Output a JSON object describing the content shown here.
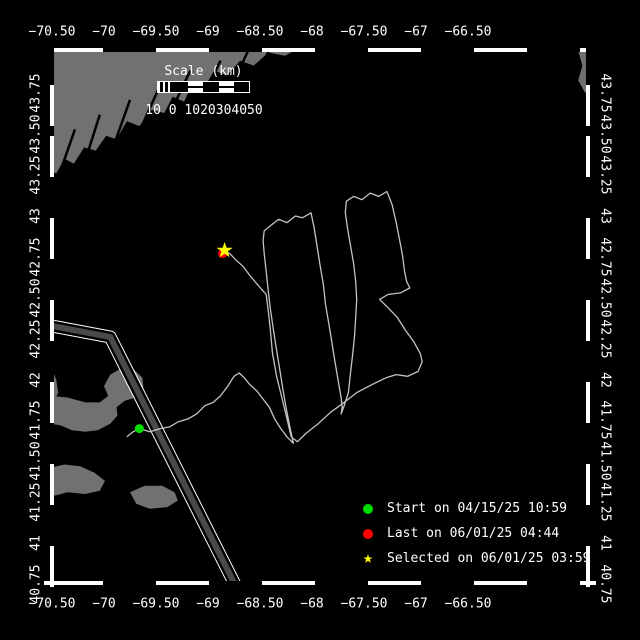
{
  "colors": {
    "background": "#000000",
    "frame": "#ffffff",
    "land": "#717171",
    "track": "#c4c4c4",
    "lane_fill": "#4a4a4a",
    "start_green": "#00dd00",
    "last_red": "#ff0000",
    "selected_yellow": "#ffff00",
    "text": "#ffffff"
  },
  "scale_bar": {
    "title": "Scale (km)",
    "tick_text": "10 0 1020304050",
    "tick_values_km": [
      10,
      0,
      10,
      20,
      30,
      40,
      50
    ]
  },
  "legend": {
    "items": [
      {
        "marker": "circle",
        "color": "#00dd00",
        "label": "Start on 04/15/25 10:59"
      },
      {
        "marker": "circle",
        "color": "#ff0000",
        "label": "Last on 06/01/25 04:44"
      },
      {
        "marker": "star",
        "color": "#ffff00",
        "label": "Selected on 06/01/25 03:59"
      }
    ]
  },
  "axes": {
    "lon_labels": [
      {
        "label": "−70.50",
        "lon": -70.5
      },
      {
        "label": "−70",
        "lon": -70.0
      },
      {
        "label": "−69.50",
        "lon": -69.5
      },
      {
        "label": "−69",
        "lon": -69.0
      },
      {
        "label": "−68.50",
        "lon": -68.5
      },
      {
        "label": "−68",
        "lon": -68.0
      },
      {
        "label": "−67.50",
        "lon": -67.5
      },
      {
        "label": "−67",
        "lon": -67.0
      },
      {
        "label": "−66.50",
        "lon": -66.5
      }
    ],
    "lat_labels": [
      {
        "label": "43.75",
        "lat": 43.75
      },
      {
        "label": "43.50",
        "lat": 43.5
      },
      {
        "label": "43.25",
        "lat": 43.25
      },
      {
        "label": "43",
        "lat": 43.0
      },
      {
        "label": "42.75",
        "lat": 42.75
      },
      {
        "label": "42.50",
        "lat": 42.5
      },
      {
        "label": "42.25",
        "lat": 42.25
      },
      {
        "label": "42",
        "lat": 42.0
      },
      {
        "label": "41.75",
        "lat": 41.75
      },
      {
        "label": "41.50",
        "lat": 41.5
      },
      {
        "label": "41.25",
        "lat": 41.25
      },
      {
        "label": "41",
        "lat": 41.0
      },
      {
        "label": "40.75",
        "lat": 40.75
      }
    ]
  },
  "chart_data": {
    "type": "line",
    "title": "Glider track map",
    "xlabel": "longitude (deg)",
    "ylabel": "latitude (deg)",
    "xlim": [
      -70.52,
      -65.33
    ],
    "ylim": [
      40.74,
      44.03
    ],
    "grid": false,
    "legend_position": "bottom-right",
    "markers": {
      "start": {
        "lon": -69.66,
        "lat": 41.7
      },
      "last": {
        "lon": -68.86,
        "lat": 42.77
      },
      "selected": {
        "lon": -68.84,
        "lat": 42.79
      }
    },
    "track_lonlat": [
      [
        -69.78,
        41.65
      ],
      [
        -69.72,
        41.68
      ],
      [
        -69.66,
        41.7
      ],
      [
        -69.56,
        41.68
      ],
      [
        -69.46,
        41.7
      ],
      [
        -69.37,
        41.71
      ],
      [
        -69.29,
        41.74
      ],
      [
        -69.19,
        41.76
      ],
      [
        -69.11,
        41.79
      ],
      [
        -69.03,
        41.84
      ],
      [
        -68.95,
        41.86
      ],
      [
        -68.88,
        41.9
      ],
      [
        -68.81,
        41.96
      ],
      [
        -68.75,
        42.02
      ],
      [
        -68.7,
        42.04
      ],
      [
        -68.65,
        42.01
      ],
      [
        -68.6,
        41.97
      ],
      [
        -68.53,
        41.93
      ],
      [
        -68.47,
        41.88
      ],
      [
        -68.41,
        41.83
      ],
      [
        -68.36,
        41.76
      ],
      [
        -68.3,
        41.7
      ],
      [
        -68.24,
        41.65
      ],
      [
        -68.18,
        41.61
      ],
      [
        -68.21,
        41.7
      ],
      [
        -68.25,
        41.83
      ],
      [
        -68.28,
        41.94
      ],
      [
        -68.31,
        42.06
      ],
      [
        -68.34,
        42.18
      ],
      [
        -68.37,
        42.3
      ],
      [
        -68.4,
        42.43
      ],
      [
        -68.42,
        42.54
      ],
      [
        -68.44,
        42.66
      ],
      [
        -68.46,
        42.77
      ],
      [
        -68.47,
        42.85
      ],
      [
        -68.46,
        42.91
      ],
      [
        -68.4,
        42.94
      ],
      [
        -68.32,
        42.98
      ],
      [
        -68.24,
        42.96
      ],
      [
        -68.16,
        43.0
      ],
      [
        -68.09,
        42.99
      ],
      [
        -68.01,
        43.02
      ],
      [
        -67.98,
        42.93
      ],
      [
        -67.95,
        42.81
      ],
      [
        -67.92,
        42.69
      ],
      [
        -67.89,
        42.58
      ],
      [
        -67.87,
        42.46
      ],
      [
        -67.84,
        42.35
      ],
      [
        -67.81,
        42.23
      ],
      [
        -67.78,
        42.11
      ],
      [
        -67.75,
        42.0
      ],
      [
        -67.72,
        41.89
      ],
      [
        -67.71,
        41.83
      ],
      [
        -67.72,
        41.79
      ],
      [
        -67.69,
        41.84
      ],
      [
        -67.65,
        41.92
      ],
      [
        -67.63,
        42.04
      ],
      [
        -67.61,
        42.15
      ],
      [
        -67.59,
        42.27
      ],
      [
        -67.58,
        42.38
      ],
      [
        -67.57,
        42.49
      ],
      [
        -67.58,
        42.6
      ],
      [
        -67.6,
        42.71
      ],
      [
        -67.63,
        42.82
      ],
      [
        -67.66,
        42.93
      ],
      [
        -67.68,
        43.02
      ],
      [
        -67.67,
        43.09
      ],
      [
        -67.6,
        43.12
      ],
      [
        -67.52,
        43.1
      ],
      [
        -67.44,
        43.14
      ],
      [
        -67.36,
        43.12
      ],
      [
        -67.28,
        43.15
      ],
      [
        -67.23,
        43.07
      ],
      [
        -67.19,
        42.96
      ],
      [
        -67.16,
        42.86
      ],
      [
        -67.13,
        42.76
      ],
      [
        -67.11,
        42.66
      ],
      [
        -67.09,
        42.6
      ],
      [
        -67.06,
        42.56
      ],
      [
        -67.15,
        42.53
      ],
      [
        -67.27,
        42.52
      ],
      [
        -67.35,
        42.49
      ],
      [
        -67.27,
        42.44
      ],
      [
        -67.18,
        42.38
      ],
      [
        -67.1,
        42.3
      ],
      [
        -67.02,
        42.23
      ],
      [
        -66.96,
        42.16
      ],
      [
        -66.94,
        42.11
      ],
      [
        -66.98,
        42.05
      ],
      [
        -67.08,
        42.02
      ],
      [
        -67.19,
        42.03
      ],
      [
        -67.29,
        42.01
      ],
      [
        -67.42,
        41.97
      ],
      [
        -67.57,
        41.92
      ],
      [
        -67.69,
        41.86
      ],
      [
        -67.82,
        41.8
      ],
      [
        -67.94,
        41.73
      ],
      [
        -68.06,
        41.67
      ],
      [
        -68.14,
        41.62
      ],
      [
        -68.2,
        41.65
      ],
      [
        -68.24,
        41.76
      ],
      [
        -68.29,
        41.89
      ],
      [
        -68.34,
        42.02
      ],
      [
        -68.38,
        42.16
      ],
      [
        -68.4,
        42.3
      ],
      [
        -68.42,
        42.42
      ],
      [
        -68.44,
        42.52
      ],
      [
        -68.51,
        42.57
      ],
      [
        -68.59,
        42.63
      ],
      [
        -68.66,
        42.69
      ],
      [
        -68.73,
        42.73
      ],
      [
        -68.79,
        42.77
      ],
      [
        -68.84,
        42.79
      ]
    ],
    "land_polygons": [
      {
        "name": "gulf-of-maine-coast",
        "points": [
          [
            -70.52,
            44.03
          ],
          [
            -68.12,
            44.03
          ],
          [
            -68.26,
            43.98
          ],
          [
            -68.42,
            44.0
          ],
          [
            -68.56,
            43.92
          ],
          [
            -68.69,
            43.95
          ],
          [
            -68.82,
            43.86
          ],
          [
            -68.94,
            43.89
          ],
          [
            -69.04,
            43.78
          ],
          [
            -69.15,
            43.81
          ],
          [
            -69.23,
            43.7
          ],
          [
            -69.34,
            43.73
          ],
          [
            -69.42,
            43.63
          ],
          [
            -69.55,
            43.65
          ],
          [
            -69.66,
            43.55
          ],
          [
            -69.78,
            43.58
          ],
          [
            -69.88,
            43.47
          ],
          [
            -69.98,
            43.49
          ],
          [
            -70.08,
            43.4
          ],
          [
            -70.19,
            43.42
          ],
          [
            -70.29,
            43.32
          ],
          [
            -70.38,
            43.35
          ],
          [
            -70.46,
            43.26
          ],
          [
            -70.52,
            43.28
          ]
        ]
      },
      {
        "name": "nova-scotia",
        "points": [
          [
            -65.33,
            44.03
          ],
          [
            -65.44,
            44.01
          ],
          [
            -65.4,
            43.92
          ],
          [
            -65.44,
            43.83
          ],
          [
            -65.38,
            43.76
          ],
          [
            -65.33,
            43.73
          ]
        ]
      },
      {
        "name": "south-shore",
        "points": [
          [
            -70.52,
            42.1
          ],
          [
            -70.46,
            42.0
          ],
          [
            -70.44,
            41.92
          ],
          [
            -70.47,
            41.88
          ],
          [
            -70.52,
            41.85
          ]
        ]
      },
      {
        "name": "cape-cod",
        "points": [
          [
            -70.52,
            41.9
          ],
          [
            -70.35,
            41.89
          ],
          [
            -70.18,
            41.86
          ],
          [
            -70.04,
            41.86
          ],
          [
            -69.96,
            41.9
          ],
          [
            -70.0,
            41.96
          ],
          [
            -69.94,
            42.03
          ],
          [
            -69.83,
            42.07
          ],
          [
            -69.71,
            42.06
          ],
          [
            -69.63,
            42.01
          ],
          [
            -69.62,
            41.94
          ],
          [
            -69.69,
            41.89
          ],
          [
            -69.8,
            41.87
          ],
          [
            -69.88,
            41.83
          ],
          [
            -69.87,
            41.78
          ],
          [
            -69.94,
            41.73
          ],
          [
            -70.06,
            41.69
          ],
          [
            -70.18,
            41.68
          ],
          [
            -70.31,
            41.69
          ],
          [
            -70.42,
            41.72
          ],
          [
            -70.52,
            41.73
          ]
        ]
      },
      {
        "name": "marthas-vineyard",
        "points": [
          [
            -70.52,
            41.46
          ],
          [
            -70.38,
            41.48
          ],
          [
            -70.23,
            41.47
          ],
          [
            -70.09,
            41.43
          ],
          [
            -69.99,
            41.38
          ],
          [
            -70.04,
            41.32
          ],
          [
            -70.18,
            41.3
          ],
          [
            -70.35,
            41.31
          ],
          [
            -70.47,
            41.29
          ],
          [
            -70.52,
            41.31
          ]
        ]
      },
      {
        "name": "nantucket",
        "points": [
          [
            -69.75,
            41.31
          ],
          [
            -69.61,
            41.35
          ],
          [
            -69.44,
            41.35
          ],
          [
            -69.32,
            41.31
          ],
          [
            -69.29,
            41.26
          ],
          [
            -69.39,
            41.22
          ],
          [
            -69.56,
            41.21
          ],
          [
            -69.69,
            41.24
          ]
        ]
      }
    ],
    "coast_inlets": [
      [
        [
          -68.6,
          44.03
        ],
        [
          -68.79,
          43.77
        ]
      ],
      [
        [
          -68.4,
          44.03
        ],
        [
          -68.55,
          43.83
        ]
      ],
      [
        [
          -68.88,
          43.95
        ],
        [
          -69.08,
          43.68
        ]
      ],
      [
        [
          -69.17,
          43.89
        ],
        [
          -69.37,
          43.62
        ]
      ],
      [
        [
          -69.46,
          43.8
        ],
        [
          -69.63,
          43.56
        ]
      ],
      [
        [
          -69.75,
          43.71
        ],
        [
          -69.89,
          43.46
        ]
      ],
      [
        [
          -70.04,
          43.62
        ],
        [
          -70.15,
          43.4
        ]
      ],
      [
        [
          -70.28,
          43.53
        ],
        [
          -70.4,
          43.31
        ]
      ]
    ],
    "shipping_lane": [
      [
        -70.52,
        42.33
      ],
      [
        -69.94,
        42.26
      ],
      [
        -68.72,
        40.72
      ]
    ]
  }
}
